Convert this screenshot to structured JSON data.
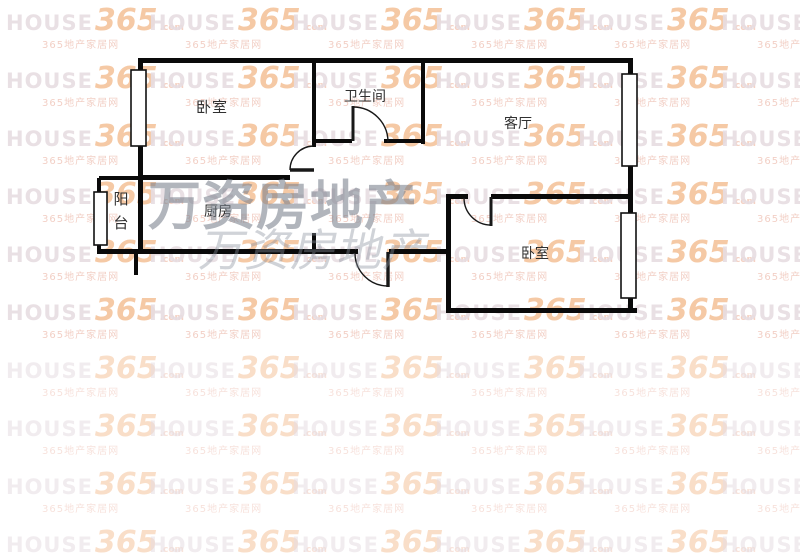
{
  "page": {
    "background_color": "#ffffff",
    "wall_color": "#0a0a0a",
    "label_color": "#303030"
  },
  "brand_watermark": {
    "brand": "HOUSE",
    "number": "365",
    "suffix": ".com",
    "subtext": "365地产家居网",
    "colors": {
      "brand": "#e7dde2",
      "number": "#f5c49c",
      "suffix": "#f3cdbd",
      "subtext": "#f1cabf"
    },
    "grid": {
      "columns": 6,
      "rows": 10,
      "column_spacing": 143,
      "row_spacing": 58,
      "x_start": 6,
      "y_start": 6,
      "faint_from_row": 6
    }
  },
  "agency_watermark": {
    "text": "万资房地产",
    "primary_color": "rgba(120,128,140,0.58)",
    "secondary_color": "rgba(138,146,158,0.40)"
  },
  "floorplan": {
    "rooms": [
      {
        "name": "bedroom-top-left",
        "label": "卧室"
      },
      {
        "name": "bathroom",
        "label": "卫生间"
      },
      {
        "name": "living-room",
        "label": "客厅"
      },
      {
        "name": "balcony",
        "label": "阳台"
      },
      {
        "name": "kitchen",
        "label": "厨房"
      },
      {
        "name": "bedroom-right",
        "label": "卧室"
      }
    ]
  }
}
